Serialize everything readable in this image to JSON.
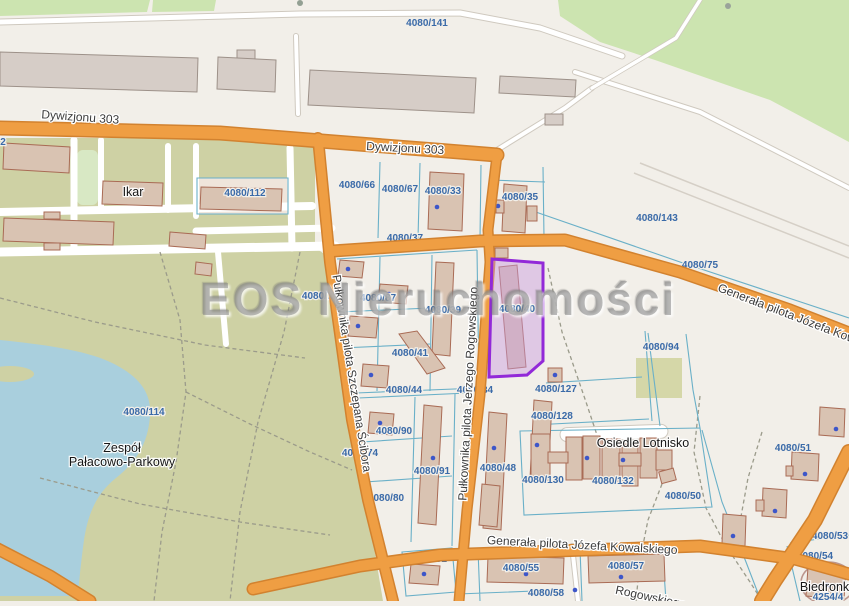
{
  "map": {
    "watermark": "EOS Nieruchomości",
    "selected_parcel": {
      "label": "4080/40",
      "stroke": "#9229d8",
      "fill": "rgba(200,153,221,0.45)"
    },
    "colors": {
      "background": "#f2efe9",
      "road_orange": "#ef9e43",
      "road_casing": "#d2822f",
      "water": "#a9cfdd",
      "forest": "#cce4b0",
      "park": "#ced1a4",
      "parcel_line": "#6ab0c8",
      "parcel_label": "#3a6aa8",
      "address_dot": "#3d56c9"
    },
    "labels": [
      {
        "t": "Dywizjonu 303",
        "x": 80,
        "y": 121,
        "r": 4,
        "cls": "street",
        "layer": "top"
      },
      {
        "t": "Dywizjonu 303",
        "x": 405,
        "y": 152,
        "r": 3,
        "cls": "street",
        "layer": "top"
      },
      {
        "t": "Pułkownika pilota Szczepana Ścibora",
        "x": 348,
        "y": 374,
        "r": 81,
        "cls": "street",
        "layer": "top"
      },
      {
        "t": "Pułkownika pilota Jerzego Rogowskiego",
        "x": 472,
        "y": 394,
        "r": -87,
        "cls": "street",
        "layer": "top"
      },
      {
        "t": "Generała pilota Józefa Kowalskiego",
        "x": 806,
        "y": 325,
        "r": 21,
        "cls": "street",
        "layer": "top"
      },
      {
        "t": "Generała pilota Józefa Kowalskiego",
        "x": 582,
        "y": 549,
        "r": 3,
        "cls": "street",
        "layer": "top"
      },
      {
        "t": "Rogowskiego",
        "x": 650,
        "y": 601,
        "r": 12,
        "cls": "street",
        "layer": "top"
      },
      {
        "t": "Ikar",
        "x": 133,
        "y": 196,
        "cls": "place",
        "layer": "top"
      },
      {
        "t": "Zespół",
        "x": 122,
        "y": 452,
        "cls": "place",
        "layer": "top"
      },
      {
        "t": "Pałacowo-Parkowy",
        "x": 122,
        "y": 466,
        "cls": "place",
        "layer": "top"
      },
      {
        "t": "Osiedle Lotnisko",
        "x": 643,
        "y": 447,
        "cls": "place",
        "layer": "top"
      },
      {
        "t": "Biedronka",
        "x": 828,
        "y": 591,
        "cls": "place",
        "layer": "top"
      },
      {
        "t": "4080/40",
        "x": 517,
        "y": 312,
        "cls": "parcel",
        "layer": "top"
      },
      {
        "t": "4080/141",
        "x": 427,
        "y": 26,
        "cls": "parcel",
        "layer": "under"
      },
      {
        "t": "4080/143",
        "x": 657,
        "y": 221,
        "cls": "parcel",
        "layer": "under"
      },
      {
        "t": "4080/112",
        "x": 245,
        "y": 196,
        "cls": "parcel",
        "layer": "under"
      },
      {
        "t": "4080/66",
        "x": 357,
        "y": 188,
        "cls": "parcel",
        "layer": "under"
      },
      {
        "t": "4080/67",
        "x": 400,
        "y": 192,
        "cls": "parcel",
        "layer": "under"
      },
      {
        "t": "4080/33",
        "x": 443,
        "y": 194,
        "cls": "parcel",
        "layer": "under"
      },
      {
        "t": "4080/35",
        "x": 520,
        "y": 200,
        "cls": "parcel",
        "layer": "under"
      },
      {
        "t": "4080/37",
        "x": 405,
        "y": 241,
        "cls": "parcel",
        "layer": "under"
      },
      {
        "t": "4080/94",
        "x": 661,
        "y": 350,
        "cls": "parcel",
        "layer": "under"
      },
      {
        "t": "4080/114",
        "x": 144,
        "y": 415,
        "cls": "parcel",
        "layer": "under"
      },
      {
        "t": "4080/78",
        "x": 320,
        "y": 299,
        "cls": "parcel",
        "layer": "under"
      },
      {
        "t": "4080/87",
        "x": 378,
        "y": 301,
        "cls": "parcel",
        "layer": "under"
      },
      {
        "t": "4080/39",
        "x": 443,
        "y": 313,
        "cls": "parcel",
        "layer": "under"
      },
      {
        "t": "4080/41",
        "x": 410,
        "y": 356,
        "cls": "parcel",
        "layer": "under"
      },
      {
        "t": "4080/44",
        "x": 404,
        "y": 393,
        "cls": "parcel",
        "layer": "under"
      },
      {
        "t": "4080/34",
        "x": 475,
        "y": 393,
        "cls": "parcel",
        "layer": "under"
      },
      {
        "t": "4080/127",
        "x": 556,
        "y": 392,
        "cls": "parcel",
        "layer": "under"
      },
      {
        "t": "4080/128",
        "x": 552,
        "y": 419,
        "cls": "parcel",
        "layer": "under"
      },
      {
        "t": "4080/90",
        "x": 394,
        "y": 434,
        "cls": "parcel",
        "layer": "under"
      },
      {
        "t": "4080/91",
        "x": 432,
        "y": 474,
        "cls": "parcel",
        "layer": "under"
      },
      {
        "t": "4080/48",
        "x": 498,
        "y": 471,
        "cls": "parcel",
        "layer": "under"
      },
      {
        "t": "4080/130",
        "x": 543,
        "y": 483,
        "cls": "parcel",
        "layer": "under"
      },
      {
        "t": "4080/132",
        "x": 613,
        "y": 484,
        "cls": "parcel",
        "layer": "under"
      },
      {
        "t": "4080/50",
        "x": 683,
        "y": 499,
        "cls": "parcel",
        "layer": "under"
      },
      {
        "t": "4080/51",
        "x": 793,
        "y": 451,
        "cls": "parcel",
        "layer": "under"
      },
      {
        "t": "4080/75",
        "x": 700,
        "y": 268,
        "cls": "parcel",
        "layer": "under"
      },
      {
        "t": "4080/74",
        "x": 360,
        "y": 456,
        "cls": "parcel",
        "layer": "under"
      },
      {
        "t": "4080/80",
        "x": 386,
        "y": 501,
        "cls": "parcel",
        "layer": "under"
      },
      {
        "t": "4080/92",
        "x": 429,
        "y": 562,
        "cls": "parcel",
        "layer": "under"
      },
      {
        "t": "4080/55",
        "x": 521,
        "y": 571,
        "cls": "parcel",
        "layer": "under"
      },
      {
        "t": "4080/57",
        "x": 626,
        "y": 569,
        "cls": "parcel",
        "layer": "under"
      },
      {
        "t": "4080/58",
        "x": 546,
        "y": 596,
        "cls": "parcel",
        "layer": "under"
      },
      {
        "t": "4080/53",
        "x": 830,
        "y": 539,
        "cls": "parcel",
        "layer": "under"
      },
      {
        "t": "4080/54",
        "x": 815,
        "y": 559,
        "cls": "parcel",
        "layer": "under"
      },
      {
        "t": "4254/4",
        "x": 828,
        "y": 600,
        "cls": "parcel",
        "layer": "under"
      },
      {
        "t": "4080",
        "x": 848,
        "y": 469,
        "cls": "parcel",
        "layer": "under"
      },
      {
        "t": "2",
        "x": 3,
        "y": 145,
        "cls": "parcel",
        "layer": "under"
      }
    ]
  }
}
